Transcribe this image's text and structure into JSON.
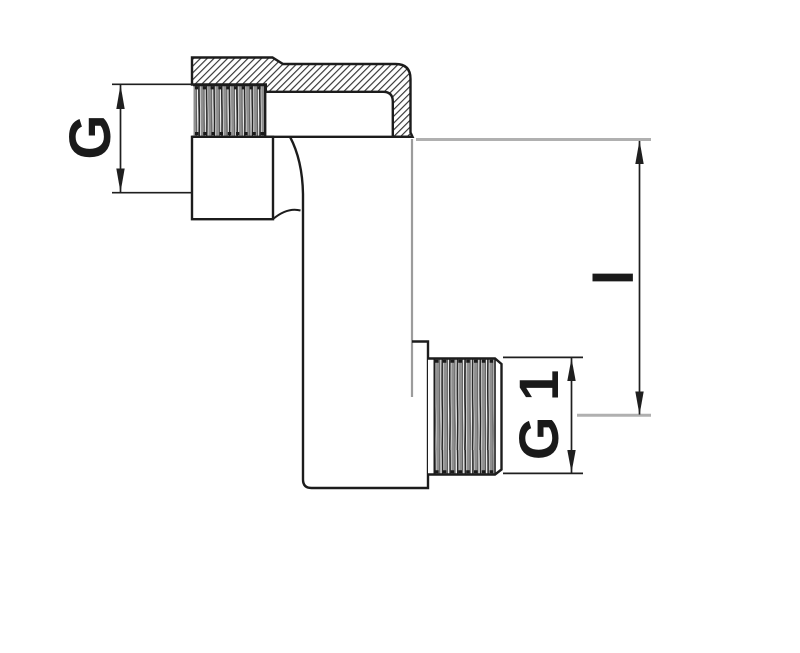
{
  "drawing": {
    "title": "offset-adapter-fitting-section-view",
    "labels": {
      "female_thread": "G",
      "male_thread": "G 1",
      "offset_length": "l"
    },
    "colors": {
      "background": "#ffffff",
      "outline": "#1c1c1c",
      "hatch_line": "#2a2a2a",
      "thread_gray": "#8f8f8f",
      "thread_dark": "#262626",
      "axis_gray": "#b0b0b0",
      "tangent_gray": "#9c9c9c",
      "dimension_line": "#1f1f1f",
      "label_text": "#1a1a1a"
    }
  }
}
